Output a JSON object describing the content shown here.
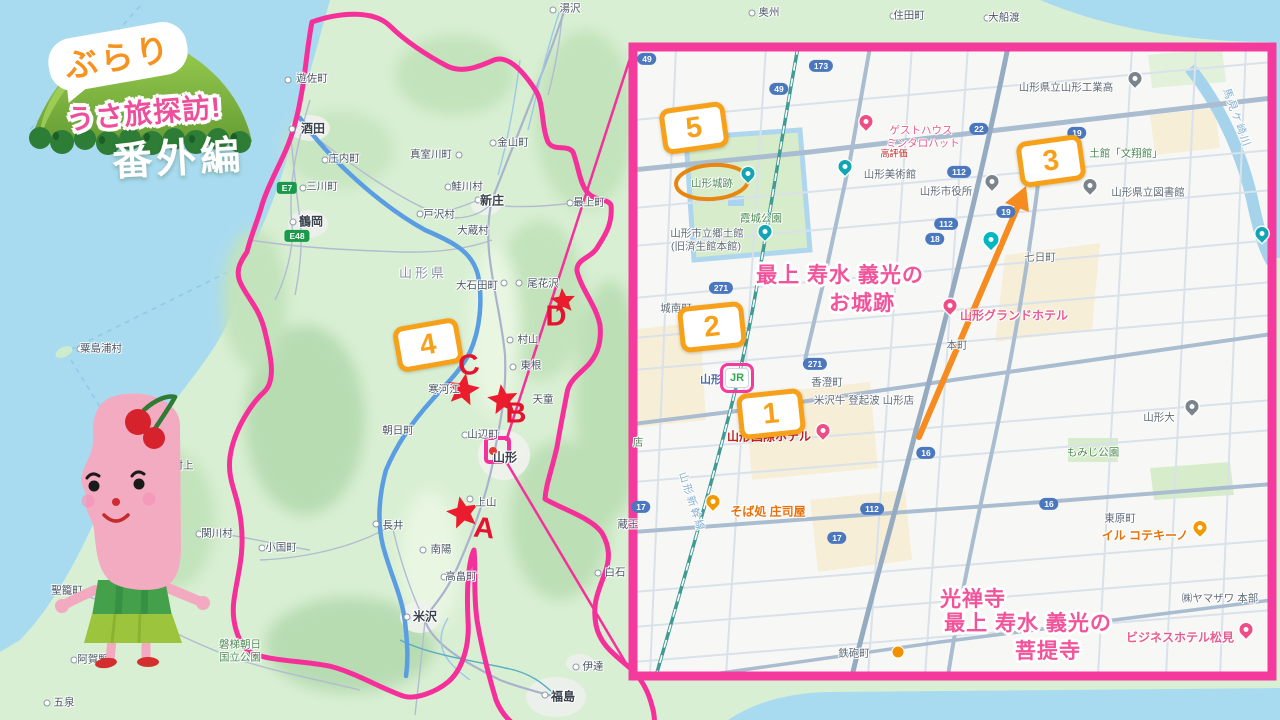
{
  "logo": {
    "bubble": "ぶらり",
    "title": "うさ旅探訪!",
    "subtitle": "番外編"
  },
  "colors": {
    "accent_pink": "#f43a9d",
    "annotation_orange": "#f7a11a",
    "star_red": "#e41430",
    "note_pink": "#f2549b",
    "sea": "#a9dbf0",
    "land": "#d9efd3"
  },
  "numbered_badges": [
    {
      "n": "1",
      "x": 771,
      "y": 414,
      "rot": -6
    },
    {
      "n": "2",
      "x": 712,
      "y": 327,
      "rot": -6
    },
    {
      "n": "3",
      "x": 1051,
      "y": 161,
      "rot": -8
    },
    {
      "n": "4",
      "x": 428,
      "y": 345,
      "rot": -10
    },
    {
      "n": "5",
      "x": 694,
      "y": 128,
      "rot": -8
    }
  ],
  "star_letters": [
    {
      "t": "A",
      "x": 484,
      "y": 529,
      "rot": 6
    },
    {
      "t": "B",
      "x": 516,
      "y": 414,
      "rot": 0
    },
    {
      "t": "C",
      "x": 469,
      "y": 366,
      "rot": -8
    },
    {
      "t": "D",
      "x": 556,
      "y": 317,
      "rot": 0
    }
  ],
  "left_map": {
    "towns": [
      {
        "t": "湯沢",
        "x": 570,
        "y": 8
      },
      {
        "t": "遊佐町",
        "x": 312,
        "y": 78
      },
      {
        "t": "酒田",
        "x": 313,
        "y": 128,
        "cls": "b"
      },
      {
        "t": "庄内町",
        "x": 344,
        "y": 158
      },
      {
        "t": "三川町",
        "x": 322,
        "y": 186
      },
      {
        "t": "鶴岡",
        "x": 311,
        "y": 221,
        "cls": "b"
      },
      {
        "t": "真室川町",
        "x": 431,
        "y": 154
      },
      {
        "t": "金山町",
        "x": 513,
        "y": 142
      },
      {
        "t": "鮭川村",
        "x": 467,
        "y": 186
      },
      {
        "t": "新庄",
        "x": 492,
        "y": 200,
        "cls": "b"
      },
      {
        "t": "戸沢村",
        "x": 439,
        "y": 214
      },
      {
        "t": "大蔵村",
        "x": 473,
        "y": 230
      },
      {
        "t": "最上町",
        "x": 589,
        "y": 202
      },
      {
        "t": "山形県",
        "x": 423,
        "y": 272,
        "cls": "region"
      },
      {
        "t": "大石田町",
        "x": 477,
        "y": 285
      },
      {
        "t": "尾花沢",
        "x": 543,
        "y": 283
      },
      {
        "t": "村山",
        "x": 528,
        "y": 339
      },
      {
        "t": "東根",
        "x": 531,
        "y": 365
      },
      {
        "t": "天童",
        "x": 543,
        "y": 399
      },
      {
        "t": "寒河江",
        "x": 444,
        "y": 389
      },
      {
        "t": "朝日町",
        "x": 398,
        "y": 430
      },
      {
        "t": "山辺町",
        "x": 483,
        "y": 434
      },
      {
        "t": "山形",
        "x": 505,
        "y": 457,
        "cls": "b"
      },
      {
        "t": "上山",
        "x": 486,
        "y": 502
      },
      {
        "t": "長井",
        "x": 393,
        "y": 525
      },
      {
        "t": "小国町",
        "x": 281,
        "y": 547
      },
      {
        "t": "南陽",
        "x": 441,
        "y": 549
      },
      {
        "t": "高畠町",
        "x": 461,
        "y": 576
      },
      {
        "t": "米沢",
        "x": 425,
        "y": 616,
        "cls": "b"
      },
      {
        "t": "蔵王",
        "x": 628,
        "y": 524
      },
      {
        "t": "白石",
        "x": 615,
        "y": 572
      },
      {
        "t": "伊達",
        "x": 593,
        "y": 666
      },
      {
        "t": "福島",
        "x": 563,
        "y": 696,
        "cls": "b"
      },
      {
        "t": "村上",
        "x": 183,
        "y": 465
      },
      {
        "t": "関川村",
        "x": 217,
        "y": 533
      },
      {
        "t": "聖籠町",
        "x": 67,
        "y": 590
      },
      {
        "t": "阿賀野",
        "x": 93,
        "y": 659
      },
      {
        "t": "五泉",
        "x": 64,
        "y": 702
      },
      {
        "t": "粟島浦村",
        "x": 101,
        "y": 348
      },
      {
        "t": "磐梯朝日",
        "x": 240,
        "y": 644,
        "cls": "green"
      },
      {
        "t": "国立公園",
        "x": 240,
        "y": 657,
        "cls": "green"
      },
      {
        "t": "奥州",
        "x": 769,
        "y": 12
      },
      {
        "t": "住田町",
        "x": 909,
        "y": 15
      },
      {
        "t": "大船渡",
        "x": 1004,
        "y": 17
      }
    ],
    "dots": [
      {
        "x": 553,
        "y": 10
      },
      {
        "x": 288,
        "y": 80
      },
      {
        "x": 292,
        "y": 129
      },
      {
        "x": 325,
        "y": 160
      },
      {
        "x": 303,
        "y": 188
      },
      {
        "x": 293,
        "y": 222
      },
      {
        "x": 459,
        "y": 155
      },
      {
        "x": 493,
        "y": 143
      },
      {
        "x": 448,
        "y": 187
      },
      {
        "x": 478,
        "y": 200
      },
      {
        "x": 420,
        "y": 214
      },
      {
        "x": 570,
        "y": 203
      },
      {
        "x": 504,
        "y": 283
      },
      {
        "x": 519,
        "y": 283
      },
      {
        "x": 510,
        "y": 340
      },
      {
        "x": 513,
        "y": 367
      },
      {
        "x": 465,
        "y": 435
      },
      {
        "x": 470,
        "y": 499
      },
      {
        "x": 376,
        "y": 524
      },
      {
        "x": 262,
        "y": 548
      },
      {
        "x": 423,
        "y": 550
      },
      {
        "x": 444,
        "y": 577
      },
      {
        "x": 407,
        "y": 617
      },
      {
        "x": 598,
        "y": 573
      },
      {
        "x": 576,
        "y": 667
      },
      {
        "x": 545,
        "y": 695
      },
      {
        "x": 199,
        "y": 534
      },
      {
        "x": 74,
        "y": 660
      },
      {
        "x": 47,
        "y": 703
      },
      {
        "x": 80,
        "y": 349
      },
      {
        "x": 752,
        "y": 13
      },
      {
        "x": 893,
        "y": 16
      },
      {
        "x": 987,
        "y": 18
      }
    ],
    "road_badges": [
      {
        "t": "E7",
        "x": 287,
        "y": 188
      },
      {
        "t": "E48",
        "x": 297,
        "y": 236
      }
    ]
  },
  "inset": {
    "labels": [
      {
        "t": "山形城跡",
        "x": 712,
        "y": 183,
        "cls": "green"
      },
      {
        "t": "霞城公園",
        "x": 761,
        "y": 218,
        "cls": "green"
      },
      {
        "t": "山形市立郷土館",
        "x": 707,
        "y": 233,
        "cls": "poi"
      },
      {
        "t": "(旧済生館本館)",
        "x": 706,
        "y": 246,
        "cls": "poi"
      },
      {
        "t": "山形美術館",
        "x": 890,
        "y": 174,
        "cls": "poi"
      },
      {
        "t": "ゲストハウス",
        "x": 921,
        "y": 130,
        "cls": "pinkpoi"
      },
      {
        "t": "ミンタロハット",
        "x": 923,
        "y": 143,
        "cls": "pinkpoi"
      },
      {
        "t": "高評価",
        "x": 894,
        "y": 153,
        "cls": "redpoi",
        "fs": 9
      },
      {
        "t": "山形市役所",
        "x": 946,
        "y": 191,
        "cls": "poi"
      },
      {
        "t": "山形県立山形工業高",
        "x": 1066,
        "y": 87,
        "cls": "poi"
      },
      {
        "t": "土館「文翔館」",
        "x": 1126,
        "y": 153,
        "cls": "green"
      },
      {
        "t": "山形県立図書館",
        "x": 1148,
        "y": 192,
        "cls": "poi"
      },
      {
        "t": "馬見ケ崎川",
        "x": 1237,
        "y": 118,
        "cls": "water",
        "rot": 70
      },
      {
        "t": "七日町",
        "x": 1040,
        "y": 257,
        "cls": "poi"
      },
      {
        "t": "城南町",
        "x": 676,
        "y": 308,
        "cls": "poi"
      },
      {
        "t": "本町",
        "x": 957,
        "y": 345,
        "cls": "poi"
      },
      {
        "t": "山形グランドホテル",
        "x": 1014,
        "y": 315,
        "cls": "pinkpoi b"
      },
      {
        "t": "香澄町",
        "x": 827,
        "y": 382,
        "cls": "poi"
      },
      {
        "t": "米沢牛 登起波 山形店",
        "x": 864,
        "y": 400,
        "cls": "poi"
      },
      {
        "t": "山形",
        "x": 711,
        "y": 379,
        "cls": "station"
      },
      {
        "t": "山形国際ホテル",
        "x": 769,
        "y": 436,
        "cls": "redpoi b"
      },
      {
        "t": "山形大",
        "x": 1159,
        "y": 417,
        "cls": "poi"
      },
      {
        "t": "もみじ公園",
        "x": 1093,
        "y": 452,
        "cls": "green"
      },
      {
        "t": "山形新幹線",
        "x": 692,
        "y": 502,
        "cls": "water",
        "rot": 72
      },
      {
        "t": "そば処 庄司屋",
        "x": 768,
        "y": 511,
        "cls": "orangepoi b"
      },
      {
        "t": "東原町",
        "x": 1120,
        "y": 518,
        "cls": "poi"
      },
      {
        "t": "イル コテキーノ",
        "x": 1145,
        "y": 535,
        "cls": "orangepoi b"
      },
      {
        "t": "㈱ヤマザワ 本部",
        "x": 1220,
        "y": 598,
        "cls": "poi"
      },
      {
        "t": "ビジネスホテル松見",
        "x": 1180,
        "y": 637,
        "cls": "pinkpoi b"
      },
      {
        "t": "鉄砲町",
        "x": 854,
        "y": 653,
        "cls": "poi"
      },
      {
        "t": "店",
        "x": 638,
        "y": 442,
        "cls": "green"
      },
      {
        "t": "最上 寿水 義光の",
        "x": 840,
        "y": 274,
        "cls": "note"
      },
      {
        "t": "お城跡",
        "x": 862,
        "y": 302,
        "cls": "note"
      },
      {
        "t": "光禅寺",
        "x": 973,
        "y": 598,
        "cls": "note"
      },
      {
        "t": "最上 寿水 義光の",
        "x": 1028,
        "y": 622,
        "cls": "note"
      },
      {
        "t": "菩提寺",
        "x": 1048,
        "y": 650,
        "cls": "note"
      }
    ],
    "road_badges": [
      {
        "t": "49",
        "x": 647,
        "y": 59
      },
      {
        "t": "173",
        "x": 821,
        "y": 66
      },
      {
        "t": "49",
        "x": 779,
        "y": 89
      },
      {
        "t": "22",
        "x": 979,
        "y": 129
      },
      {
        "t": "19",
        "x": 1077,
        "y": 133
      },
      {
        "t": "112",
        "x": 959,
        "y": 172
      },
      {
        "t": "49",
        "x": 1064,
        "y": 176
      },
      {
        "t": "19",
        "x": 1006,
        "y": 212
      },
      {
        "t": "112",
        "x": 946,
        "y": 224
      },
      {
        "t": "18",
        "x": 935,
        "y": 239
      },
      {
        "t": "271",
        "x": 721,
        "y": 288
      },
      {
        "t": "271",
        "x": 815,
        "y": 364
      },
      {
        "t": "16",
        "x": 926,
        "y": 453
      },
      {
        "t": "17",
        "x": 641,
        "y": 507
      },
      {
        "t": "112",
        "x": 872,
        "y": 509
      },
      {
        "t": "17",
        "x": 837,
        "y": 538
      },
      {
        "t": "16",
        "x": 1049,
        "y": 504
      }
    ],
    "pins": [
      {
        "x": 866,
        "y": 128,
        "cls": "pink"
      },
      {
        "x": 950,
        "y": 312,
        "cls": "pink"
      },
      {
        "x": 823,
        "y": 437,
        "cls": "pink"
      },
      {
        "x": 1246,
        "y": 636,
        "cls": "pink"
      },
      {
        "x": 713,
        "y": 508,
        "cls": "orange"
      },
      {
        "x": 1200,
        "y": 534,
        "cls": "orange"
      },
      {
        "x": 748,
        "y": 180,
        "cls": "teal"
      },
      {
        "x": 765,
        "y": 238,
        "cls": "teal"
      },
      {
        "x": 845,
        "y": 173,
        "cls": "teal"
      },
      {
        "x": 1262,
        "y": 240,
        "cls": "teal"
      },
      {
        "x": 992,
        "y": 188,
        "cls": "gray"
      },
      {
        "x": 1135,
        "y": 85,
        "cls": "gray"
      },
      {
        "x": 1090,
        "y": 192,
        "cls": "gray"
      },
      {
        "x": 1192,
        "y": 413,
        "cls": "gray"
      }
    ],
    "jr_badge": "JR"
  }
}
